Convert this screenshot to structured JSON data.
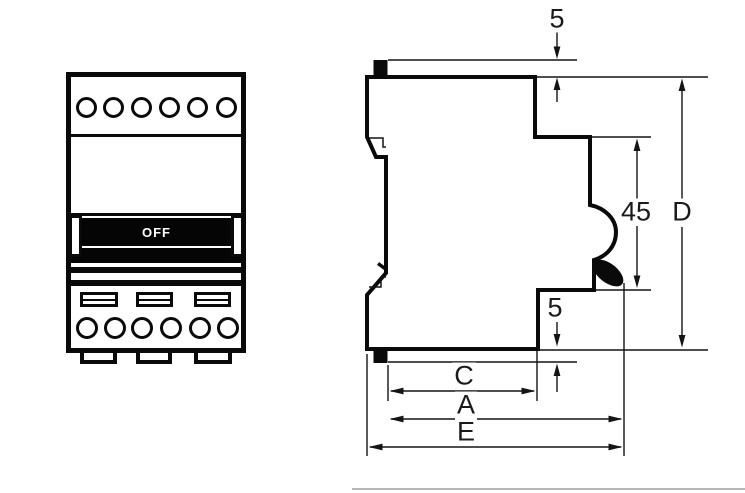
{
  "front_view": {
    "switch_label": "OFF"
  },
  "side_view": {
    "dimensions": {
      "top_gap": "5",
      "handle_height": "45",
      "overall_height": "D",
      "bottom_gap": "5",
      "depth_c": "C",
      "depth_a": "A",
      "depth_e": "E"
    }
  },
  "colors": {
    "line": "#0a0a0a",
    "switch_bg": "#050505",
    "switch_text": "#ffffff"
  }
}
